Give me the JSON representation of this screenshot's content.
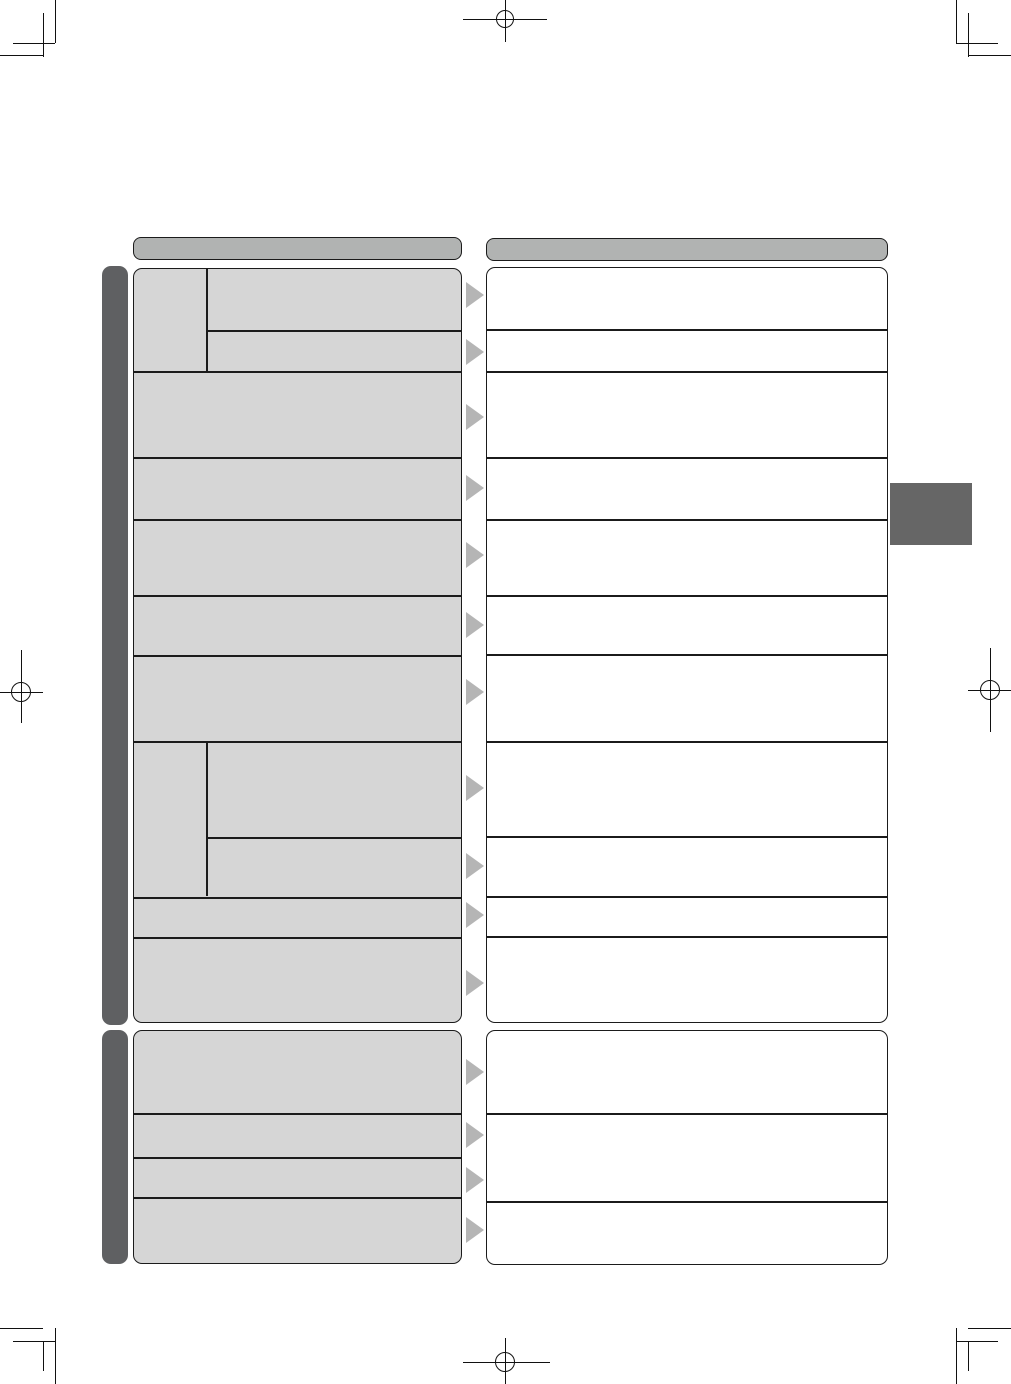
{
  "document": {
    "kind": "manual-troubleshooting-page-template",
    "visible_text": "",
    "left_column_rows_visible": 15,
    "right_column_cells_visible": 14,
    "connector_arrow_count": 15,
    "section_bars": 2,
    "chapter_tab_count": 1
  },
  "colors": {
    "page_bg": "#ffffff",
    "mark": "#111111",
    "border": "#1b1b1b",
    "header_fill": "#b1b3b2",
    "cell_fill": "#d6d6d6",
    "solution_fill": "#ffffff",
    "sidebar": "#5f6062",
    "arrow": "#b5b5b5",
    "tab": "#666666"
  },
  "sections": [
    {
      "id": 1,
      "symptom_rows": 11,
      "remedy_cells": 11,
      "rows_with_subcolumn": 2
    },
    {
      "id": 2,
      "symptom_rows": 4,
      "remedy_cells": 3,
      "rows_with_subcolumn": 0
    }
  ]
}
